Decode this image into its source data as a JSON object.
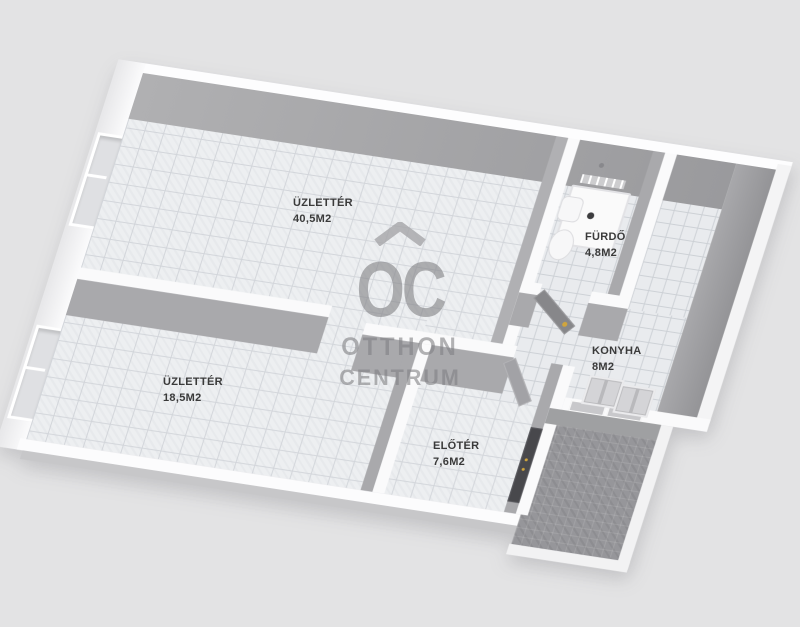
{
  "watermark": {
    "initials": "OC",
    "line1": "OTTHON",
    "line2": "CENTRUM"
  },
  "rooms": [
    {
      "name": "ÜZLETTÉR",
      "area": "40,5M2"
    },
    {
      "name": "ÜZLETTÉR",
      "area": "18,5M2"
    },
    {
      "name": "FÜRDŐ",
      "area": "4,8M2"
    },
    {
      "name": "KONYHA",
      "area": "8M2"
    },
    {
      "name": "ELŐTÉR",
      "area": "7,6M2"
    }
  ],
  "colors": {
    "background": "#e3e3e4",
    "wall_face": "#a9a9ac",
    "wall_top": "#fafafb",
    "floor_tile": "#edeff1",
    "terrace_paving": "#96969a",
    "door_handle_accent": "#d0a53d",
    "entrance_door": "#48484c",
    "label_text": "#3a3a3a",
    "watermark_gray": "#9c9c9e"
  }
}
